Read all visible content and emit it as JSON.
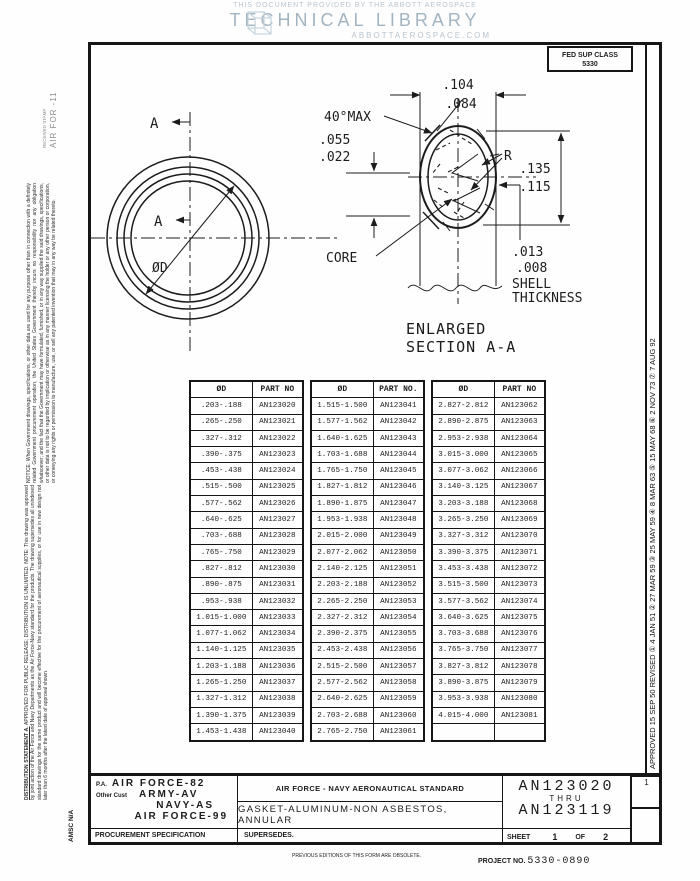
{
  "header": {
    "line1": "THIS DOCUMENT PROVIDED BY THE ABBOTT AEROSPACE",
    "line2": "TECHNICAL LIBRARY",
    "line3": "ABBOTTAEROSPACE.COM"
  },
  "fed_sup_class": {
    "label": "FED SUP CLASS",
    "value": "5330"
  },
  "margins": {
    "stamp_small": "RECEIVED STAMP",
    "stamp_main": "AIR FOR      -11",
    "left_notice": "NOTICE: When Government drawings, specifications, or other data are used for any purpose other than in connection with a definitely related Government procurement operation, the United States Government thereby incurs no responsibility nor any obligation whatsoever; and the fact that the Government may have formulated, furnished, or in any way supplied the said drawings, specifications, or other data is not to be regarded by implication or otherwise as in any manner licensing the holder or any other person or corporation, or conveying any rights or permission to manufacture, use, or sell any patented invention that may in any way be related thereto.",
    "dist_heading": "DISTRIBUTION STATEMENT A.",
    "dist_body": "APPROVED FOR PUBLIC RELEASE; DISTRIBUTION IS UNLIMITED. NOTE: This drawing was approved by joint action of the Air Force and Navy Departments as the Air Force-Navy standard for the products. The drawing supersedes all unindexed standard drawings for the same product and will become effective for the procurement of aeronautical supplies, or for use in new design not later than 6 months after the latest date of approval shown.",
    "amsc": "AMSC N/A",
    "right_revisions": "APPROVED  15 SEP 50        REVISED  ① 4 JAN 51  ② 27 MAR 59  ③ 25 MAY 59  ④ 8 MAR 63  ⑤ 15 MAY 68  ⑥ 2 NOV 73  ⑦ 7 AUG 92",
    "revision_box_no": "1"
  },
  "drawing": {
    "section_a_top": "A",
    "section_a_mid": "A",
    "diameter_label": "ØD",
    "dims": {
      "top_max": ".104",
      "top_min": ".084",
      "angle": "40°MAX",
      "left_max": ".055",
      "left_min": ".022",
      "radius": "R",
      "right_max": ".135",
      "right_min": ".115",
      "core": "CORE",
      "shell_max": ".013",
      "shell_min": ".008",
      "shell_word1": "SHELL",
      "shell_word2": "THICKNESS"
    },
    "caption_line1": "ENLARGED",
    "caption_line2": "SECTION A-A"
  },
  "part_table": {
    "groups": [
      {
        "headers": [
          "ØD",
          "PART NO"
        ],
        "rows": [
          [
            ".203-.188",
            "AN123020"
          ],
          [
            ".265-.250",
            "AN123021"
          ],
          [
            ".327-.312",
            "AN123022"
          ],
          [
            ".390-.375",
            "AN123023"
          ],
          [
            ".453-.438",
            "AN123024"
          ],
          [
            ".515-.500",
            "AN123025"
          ],
          [
            ".577-.562",
            "AN123026"
          ],
          [
            ".640-.625",
            "AN123027"
          ],
          [
            ".703-.688",
            "AN123028"
          ],
          [
            ".765-.750",
            "AN123029"
          ],
          [
            ".827-.812",
            "AN123030"
          ],
          [
            ".890-.875",
            "AN123031"
          ],
          [
            ".953-.938",
            "AN123032"
          ],
          [
            "1.015-1.000",
            "AN123033"
          ],
          [
            "1.077-1.062",
            "AN123034"
          ],
          [
            "1.140-1.125",
            "AN123035"
          ],
          [
            "1.203-1.188",
            "AN123036"
          ],
          [
            "1.265-1.250",
            "AN123037"
          ],
          [
            "1.327-1.312",
            "AN123038"
          ],
          [
            "1.390-1.375",
            "AN123039"
          ],
          [
            "1.453-1.438",
            "AN123040"
          ]
        ]
      },
      {
        "headers": [
          "ØD",
          "PART NO."
        ],
        "rows": [
          [
            "1.515-1.500",
            "AN123041"
          ],
          [
            "1.577-1.562",
            "AN123042"
          ],
          [
            "1.640-1.625",
            "AN123043"
          ],
          [
            "1.703-1.688",
            "AN123044"
          ],
          [
            "1.765-1.750",
            "AN123045"
          ],
          [
            "1.827-1.812",
            "AN123046"
          ],
          [
            "1.890-1.875",
            "AN123047"
          ],
          [
            "1.953-1.938",
            "AN123048"
          ],
          [
            "2.015-2.000",
            "AN123049"
          ],
          [
            "2.077-2.062",
            "AN123050"
          ],
          [
            "2.140-2.125",
            "AN123051"
          ],
          [
            "2.203-2.188",
            "AN123052"
          ],
          [
            "2.265-2.250",
            "AN123053"
          ],
          [
            "2.327-2.312",
            "AN123054"
          ],
          [
            "2.390-2.375",
            "AN123055"
          ],
          [
            "2.453-2.438",
            "AN123056"
          ],
          [
            "2.515-2.500",
            "AN123057"
          ],
          [
            "2.577-2.562",
            "AN123058"
          ],
          [
            "2.640-2.625",
            "AN123059"
          ],
          [
            "2.703-2.688",
            "AN123060"
          ],
          [
            "2.765-2.750",
            "AN123061"
          ]
        ]
      },
      {
        "headers": [
          "ØD",
          "PART NO"
        ],
        "rows": [
          [
            "2.827-2.812",
            "AN123062"
          ],
          [
            "2.890-2.875",
            "AN123063"
          ],
          [
            "2.953-2.938",
            "AN123064"
          ],
          [
            "3.015-3.000",
            "AN123065"
          ],
          [
            "3.077-3.062",
            "AN123066"
          ],
          [
            "3.140-3.125",
            "AN123067"
          ],
          [
            "3.203-3.188",
            "AN123068"
          ],
          [
            "3.265-3.250",
            "AN123069"
          ],
          [
            "3.327-3.312",
            "AN123070"
          ],
          [
            "3.390-3.375",
            "AN123071"
          ],
          [
            "3.453-3.438",
            "AN123072"
          ],
          [
            "3.515-3.500",
            "AN123073"
          ],
          [
            "3.577-3.562",
            "AN123074"
          ],
          [
            "3.640-3.625",
            "AN123075"
          ],
          [
            "3.703-3.688",
            "AN123076"
          ],
          [
            "3.765-3.750",
            "AN123077"
          ],
          [
            "3.827-3.812",
            "AN123078"
          ],
          [
            "3.890-3.875",
            "AN123079"
          ],
          [
            "3.953-3.938",
            "AN123080"
          ],
          [
            "4.015-4.000",
            "AN123081"
          ],
          [
            "",
            ""
          ]
        ]
      }
    ]
  },
  "title_block": {
    "pa_label": "P.A.",
    "pa_value": "AIR FORCE-82",
    "other_cust_label": "Other Cust",
    "other_cust_1": "ARMY-AV",
    "other_cust_2": "NAVY-AS",
    "other_cust_3": "AIR FORCE-99",
    "procurement": "PROCUREMENT SPECIFICATION",
    "standard_line": "AIR FORCE - NAVY AERONAUTICAL STANDARD",
    "title": "GASKET-ALUMINUM-NON ASBESTOS, ANNULAR",
    "supersedes": "SUPERSEDES.",
    "part_from": "AN123020",
    "thru": "THRU",
    "part_to": "AN123119",
    "sheet_label": "SHEET",
    "sheet_no": "1",
    "of_label": "OF",
    "sheet_total": "2",
    "previous_editions": "PREVIOUS EDITIONS OF THIS FORM ARE OBSOLETE.",
    "project_label": "PROJECT NO.",
    "project_no": "5330-0890"
  },
  "colors": {
    "ink": "#1c1c1c",
    "header_blue": "#a3b4c1",
    "stamp_gray": "#8d8d8d"
  }
}
